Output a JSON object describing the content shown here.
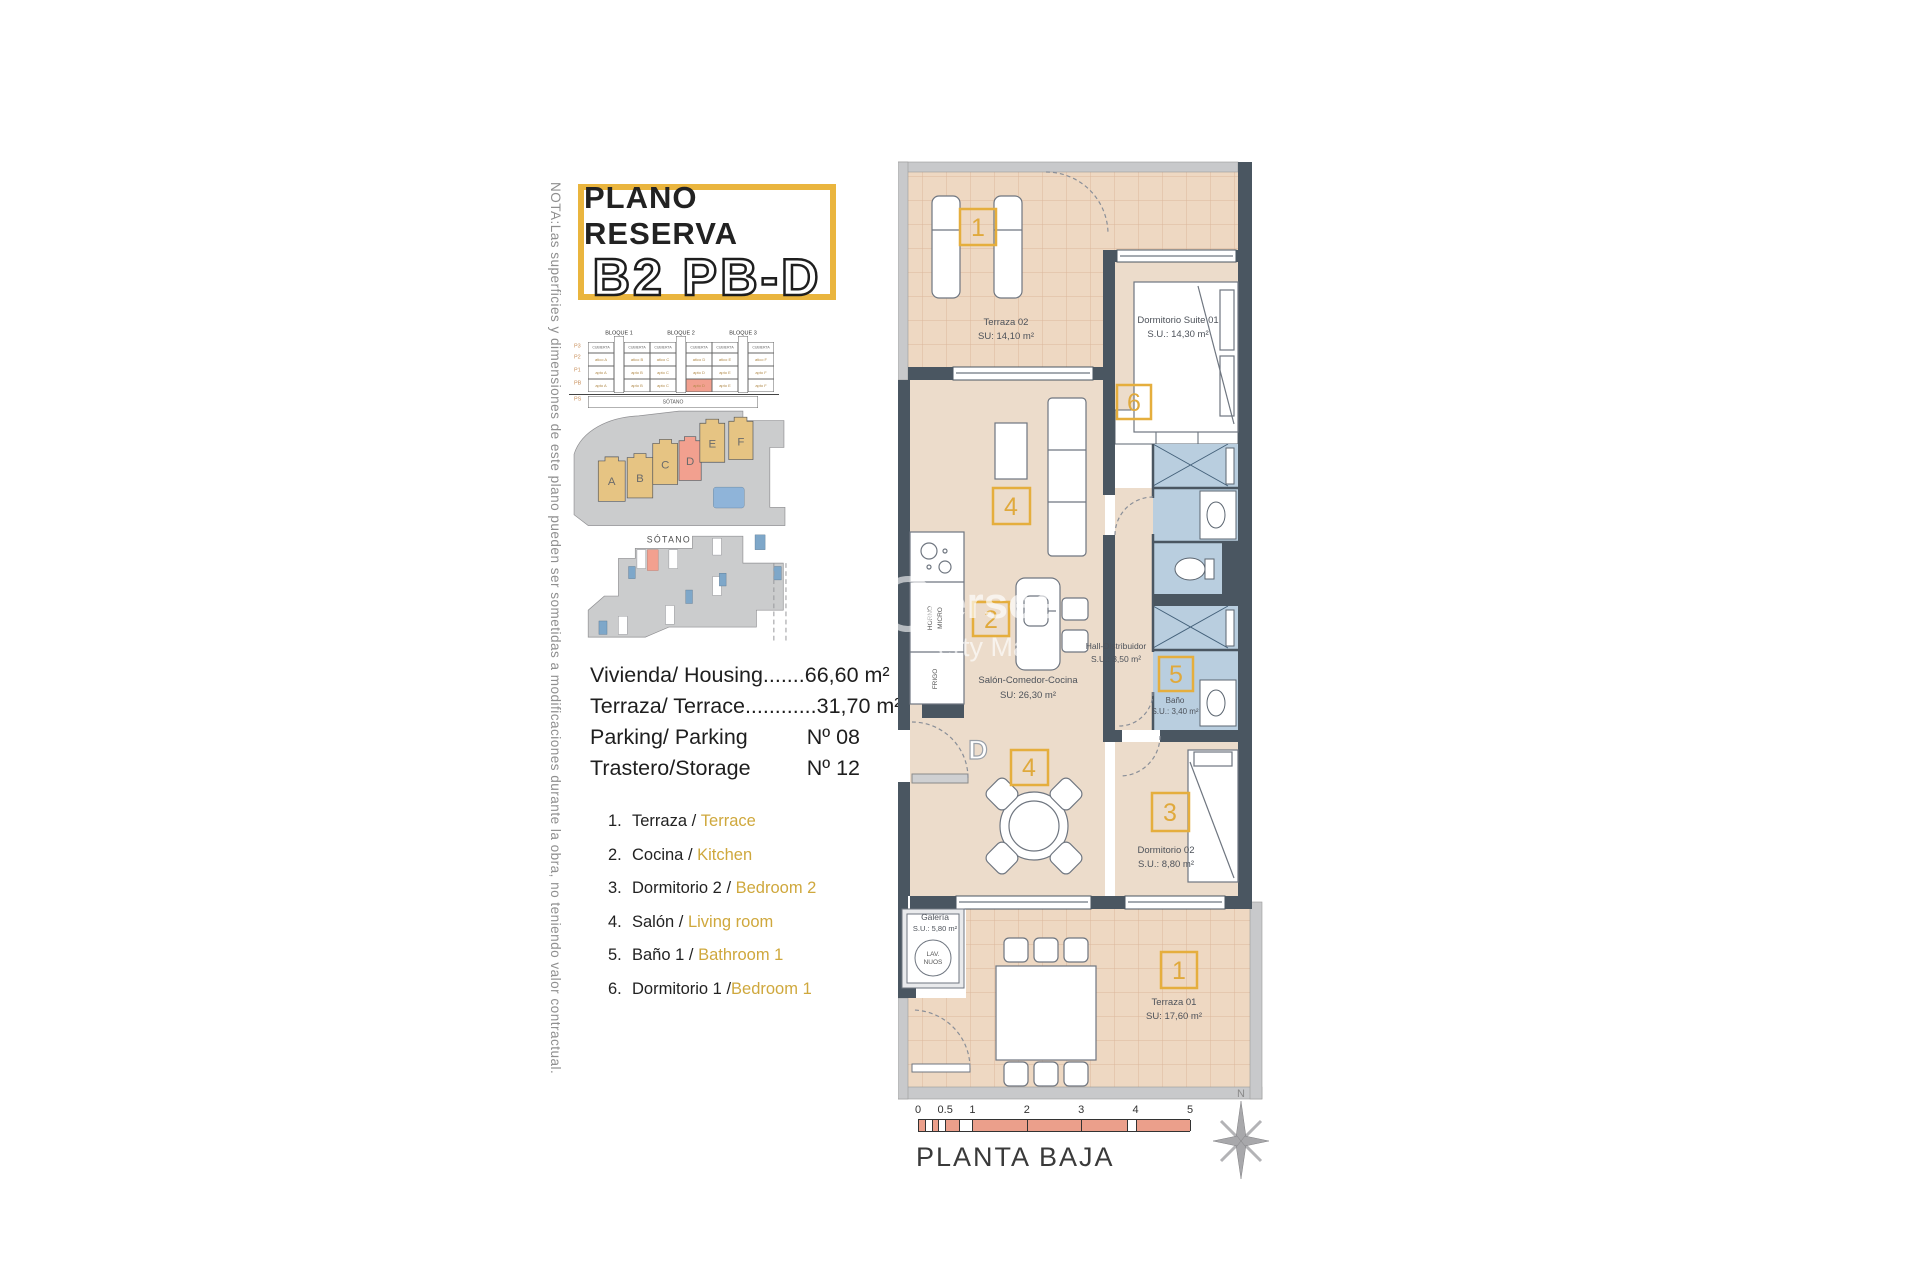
{
  "note": "NOTA:Las superficies y dimensiones de este plano pueden ser sometidas a modificaciones durante la obra, no teniendo valor contractual.",
  "title": {
    "line1": "PLANO RESERVA",
    "line2": "B2 PB-D"
  },
  "block_table": {
    "blocks": [
      "BLOQUE 1",
      "BLOQUE 2",
      "BLOQUE 3"
    ],
    "row_labels": [
      "P3",
      "P2",
      "P1",
      "PB",
      "PS"
    ],
    "header_cell": "CUBIERTA",
    "rows": [
      [
        "atico A",
        "atico B",
        "atico C",
        "atico D",
        "atico E",
        "atico F"
      ],
      [
        "apto A",
        "apto B",
        "apto C",
        "apto D",
        "apto E",
        "apto F"
      ],
      [
        "apto A",
        "apto B",
        "apto C",
        "apto D",
        "apto E",
        "apto F"
      ]
    ],
    "highlight": {
      "row": 2,
      "col": 3
    },
    "basement_label": "SÓTANO"
  },
  "site": {
    "blocks": [
      "A",
      "B",
      "C",
      "D",
      "E",
      "F"
    ],
    "highlighted": "D"
  },
  "sotano_label": "SÓTANO",
  "summary": {
    "rows": [
      {
        "label": "Vivienda/ Housing.......",
        "value": "66,60 m²"
      },
      {
        "label": "Terraza/ Terrace............",
        "value": "31,70 m²"
      },
      {
        "label": "Parking/ Parking",
        "value": "Nº 08"
      },
      {
        "label": "Trastero/Storage",
        "value": "Nº 12"
      }
    ]
  },
  "legend": {
    "items": [
      {
        "num": "1.",
        "es": "Terraza",
        "sep": " / ",
        "en": "Terrace"
      },
      {
        "num": "2.",
        "es": "Cocina",
        "sep": " / ",
        "en": "Kitchen"
      },
      {
        "num": "3.",
        "es": "Dormitorio 2",
        "sep": " / ",
        "en": "Bedroom 2"
      },
      {
        "num": "4.",
        "es": "Salón",
        "sep": " / ",
        "en": "Living room"
      },
      {
        "num": "5.",
        "es": "Baño 1",
        "sep": " / ",
        "en": "Bathroom 1"
      },
      {
        "num": "6.",
        "es": "Dormitorio 1",
        "sep": " /",
        "en": "Bedroom 1"
      }
    ]
  },
  "floorplan": {
    "rooms": {
      "terraza02": {
        "name": "Terraza 02",
        "area": "SU: 14,10 m²"
      },
      "suite": {
        "name": "Dormitorio Suite 01",
        "area": "S.U.: 14,30 m²"
      },
      "salon": {
        "name": "Salón-Comedor-Cocina",
        "area": "SU: 26,30 m²"
      },
      "hall": {
        "name": "Hall-Distribuidor",
        "area": "S.U.: 3,50 m²"
      },
      "bano": {
        "name": "Baño",
        "area": "S.U.: 3,40 m²"
      },
      "dorm02": {
        "name": "Dormitorio 02",
        "area": "S.U.: 8,80 m²"
      },
      "galeria": {
        "name": "Galería",
        "area": "S.U.: 5,80 m²",
        "lav1": "LAV.",
        "lav2": "NUOS"
      },
      "terraza01": {
        "name": "Terraza 01",
        "area": "SU: 17,60 m²"
      }
    },
    "tags": {
      "t1": "1",
      "t2": "2",
      "t3": "3",
      "t4": "4",
      "t5": "5",
      "t6": "6"
    },
    "entrance_label": "D",
    "kitchen": {
      "oven1": "HORNO",
      "oven2": "MICRO",
      "fridge": "FRIGO"
    }
  },
  "watermark": {
    "line1": "ersee",
    "line2": "erty Ma"
  },
  "scalebar": {
    "ticks": [
      "0",
      "0.5",
      "1",
      "2",
      "3",
      "4",
      "5"
    ],
    "tick_fracs": [
      0,
      0.1,
      0.2,
      0.4,
      0.6,
      0.8,
      1
    ],
    "segments": [
      {
        "from": 0,
        "to": 0.025,
        "c": "salmon"
      },
      {
        "from": 0.025,
        "to": 0.05,
        "c": "white"
      },
      {
        "from": 0.05,
        "to": 0.075,
        "c": "salmon"
      },
      {
        "from": 0.075,
        "to": 0.1,
        "c": "white"
      },
      {
        "from": 0.1,
        "to": 0.15,
        "c": "salmon"
      },
      {
        "from": 0.15,
        "to": 0.2,
        "c": "white"
      },
      {
        "from": 0.2,
        "to": 0.4,
        "c": "salmon"
      },
      {
        "from": 0.4,
        "to": 0.6,
        "c": "salmon"
      },
      {
        "from": 0.6,
        "to": 0.77,
        "c": "salmon"
      },
      {
        "from": 0.77,
        "to": 0.8,
        "c": "white"
      },
      {
        "from": 0.8,
        "to": 1,
        "c": "salmon"
      }
    ],
    "label": "PLANTA BAJA"
  },
  "compass": {
    "label": "N"
  },
  "colors": {
    "accent_yellow": "#eab53e",
    "highlight_salmon": "#f2a08f",
    "wall_dark": "#4a5661",
    "floor_beige": "#ecdccb",
    "terrace_beige": "#eed8c2",
    "bath_blue": "#b9cedf",
    "legend_gold": "#cfa83d",
    "site_gray": "#cbcccd",
    "site_tan": "#e6c483"
  }
}
